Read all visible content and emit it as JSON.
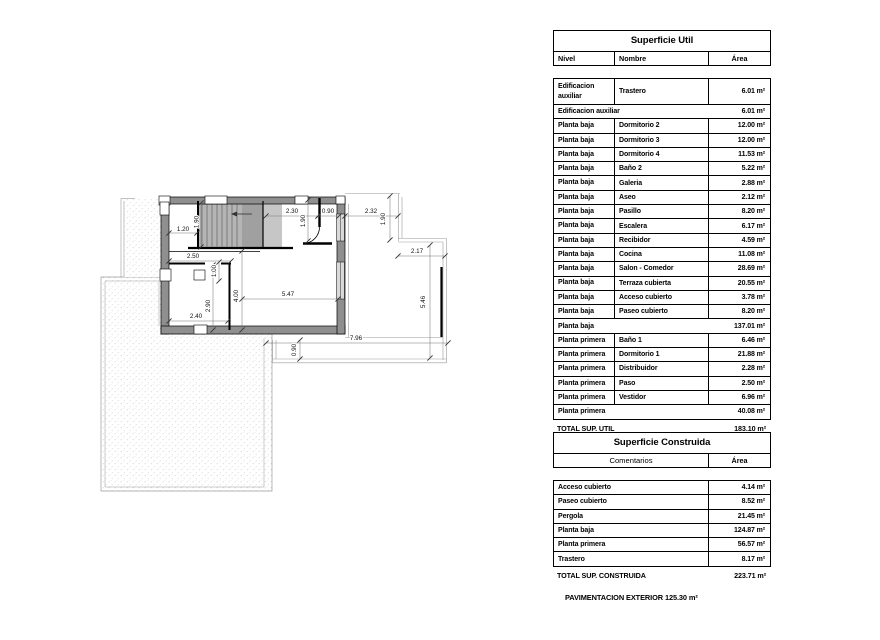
{
  "plan": {
    "dimension_labels": [
      {
        "text": "1.20",
        "x": 183,
        "y": 231,
        "rot": 0
      },
      {
        "text": "1.90",
        "x": 198.5,
        "y": 222,
        "rot": -90
      },
      {
        "text": "2.30",
        "x": 292,
        "y": 213,
        "rot": 0
      },
      {
        "text": "0.90",
        "x": 328,
        "y": 213,
        "rot": 0
      },
      {
        "text": "2.32",
        "x": 371,
        "y": 213,
        "rot": 0
      },
      {
        "text": "1.90",
        "x": 305,
        "y": 221,
        "rot": -90
      },
      {
        "text": "1.90",
        "x": 385,
        "y": 219,
        "rot": -90
      },
      {
        "text": "2.17",
        "x": 417,
        "y": 253,
        "rot": 0
      },
      {
        "text": "5.46",
        "x": 425,
        "y": 302,
        "rot": -90
      },
      {
        "text": "2.50",
        "x": 193,
        "y": 258,
        "rot": 0
      },
      {
        "text": "1.00",
        "x": 216,
        "y": 271,
        "rot": -90
      },
      {
        "text": "4.00",
        "x": 238,
        "y": 296,
        "rot": -90
      },
      {
        "text": "5.47",
        "x": 288,
        "y": 296,
        "rot": 0
      },
      {
        "text": "2.90",
        "x": 210,
        "y": 306,
        "rot": -90
      },
      {
        "text": "2.40",
        "x": 196,
        "y": 318,
        "rot": 0
      },
      {
        "text": "7.96",
        "x": 356,
        "y": 340,
        "rot": 0
      },
      {
        "text": "0.90",
        "x": 296,
        "y": 350,
        "rot": -90
      }
    ]
  },
  "tables": {
    "util": {
      "title": "Superficie Util",
      "columns": [
        "Nivel",
        "Nombre",
        "Área"
      ],
      "rows": [
        {
          "type": "item",
          "tall": true,
          "nivel": "Edificacion auxiliar",
          "nombre": "Trastero",
          "area": "6.01 m²"
        },
        {
          "type": "subtotal",
          "label": "Edificacion auxiliar",
          "area": "6.01 m²"
        },
        {
          "type": "item",
          "nivel": "Planta baja",
          "nombre": "Dormitorio 2",
          "area": "12.00 m²"
        },
        {
          "type": "item",
          "nivel": "Planta baja",
          "nombre": "Dormitorio 3",
          "area": "12.00 m²"
        },
        {
          "type": "item",
          "nivel": "Planta baja",
          "nombre": "Dormitorio 4",
          "area": "11.53 m²"
        },
        {
          "type": "item",
          "nivel": "Planta baja",
          "nombre": "Baño 2",
          "area": "5.22 m²"
        },
        {
          "type": "item",
          "nivel": "Planta baja",
          "nombre": "Galeria",
          "area": "2.88 m²"
        },
        {
          "type": "item",
          "nivel": "Planta baja",
          "nombre": "Aseo",
          "area": "2.12 m²"
        },
        {
          "type": "item",
          "nivel": "Planta baja",
          "nombre": "Pasillo",
          "area": "8.20 m²"
        },
        {
          "type": "item",
          "nivel": "Planta baja",
          "nombre": "Escalera",
          "area": "6.17 m²"
        },
        {
          "type": "item",
          "nivel": "Planta baja",
          "nombre": "Recibidor",
          "area": "4.59 m²"
        },
        {
          "type": "item",
          "nivel": "Planta baja",
          "nombre": "Cocina",
          "area": "11.08 m²"
        },
        {
          "type": "item",
          "nivel": "Planta baja",
          "nombre": "Salon - Comedor",
          "area": "28.69 m²"
        },
        {
          "type": "item",
          "nivel": "Planta baja",
          "nombre": "Terraza cubierta",
          "area": "20.55 m²"
        },
        {
          "type": "item",
          "nivel": "Planta baja",
          "nombre": "Acceso cubierto",
          "area": "3.78 m²"
        },
        {
          "type": "item",
          "nivel": "Planta baja",
          "nombre": "Paseo cubierto",
          "area": "8.20 m²"
        },
        {
          "type": "subtotal",
          "label": "Planta baja",
          "area": "137.01 m²"
        },
        {
          "type": "item",
          "nivel": "Planta primera",
          "nombre": "Baño 1",
          "area": "6.46 m²"
        },
        {
          "type": "item",
          "nivel": "Planta primera",
          "nombre": "Dormitorio 1",
          "area": "21.88 m²"
        },
        {
          "type": "item",
          "nivel": "Planta primera",
          "nombre": "Distribuidor",
          "area": "2.28 m²"
        },
        {
          "type": "item",
          "nivel": "Planta primera",
          "nombre": "Paso",
          "area": "2.50 m²"
        },
        {
          "type": "item",
          "nivel": "Planta primera",
          "nombre": "Vestidor",
          "area": "6.96 m²"
        },
        {
          "type": "subtotal",
          "label": "Planta primera",
          "area": "40.08 m²"
        }
      ],
      "total": {
        "label": "TOTAL SUP. UTIL",
        "area": "183.10 m²"
      }
    },
    "construida": {
      "title": "Superficie Construida",
      "columns": [
        "Comentarios",
        "Área"
      ],
      "rows": [
        {
          "label": "Acceso cubierto",
          "area": "4.14 m²"
        },
        {
          "label": "Paseo cubierto",
          "area": "8.52 m²"
        },
        {
          "label": "Pergola",
          "area": "21.45 m²"
        },
        {
          "label": "Planta baja",
          "area": "124.87 m²"
        },
        {
          "label": "Planta primera",
          "area": "56.57 m²"
        },
        {
          "label": "Trastero",
          "area": "8.17 m²"
        }
      ],
      "total": {
        "label": "TOTAL SUP. CONSTRUIDA",
        "area": "223.71 m²"
      }
    }
  },
  "footnote": "PAVIMENTACION EXTERIOR 125.30 m²"
}
